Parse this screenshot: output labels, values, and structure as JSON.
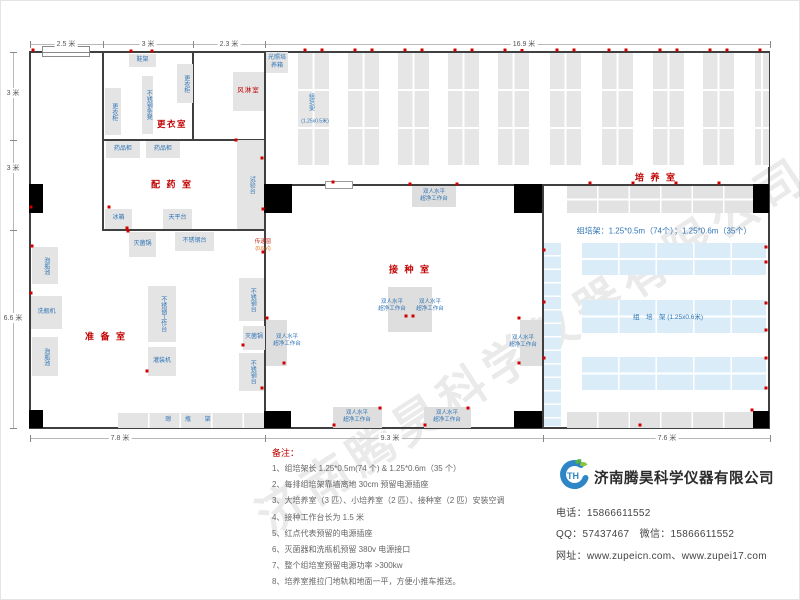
{
  "watermark": "济南腾昊科学仪器有限公司",
  "company": {
    "name": "济南腾昊科学仪器有限公司",
    "logo_text": "TH",
    "logo_colors": {
      "blue": "#2f86c6",
      "green": "#5cb54a"
    },
    "contacts": [
      "电话：15866611552",
      "QQ：57437467　微信：15866611552",
      "网址：www.zupeicn.com、www.zupei17.com"
    ]
  },
  "notes": {
    "title": "备注：",
    "items": [
      "1、组培架长 1.25*0.5m(74 个) & 1.25*0.6m（35 个）",
      "2、每排组培架靠墙离地 30cm 预留电源插座",
      "3、大培养室（3 匹）、小培养室（2 匹）、接种室（2 匹）安装空调",
      "4、接种工作台长为 1.5 米",
      "5、红点代表预留的电源插座",
      "6、灭菌器和洗瓶机预留 380v 电源接口",
      "7、整个组培室预留电源功率 >300kw",
      "8、培养室推拉门地轨和地面一平，方便小推车推送。"
    ]
  },
  "colors": {
    "room_label": "#c00000",
    "equip_label": "#2e74b5",
    "socket_dot": "#d00000",
    "gray_fill": "#e4e4e4",
    "blue_fill": "#d9ecf8",
    "wall": "#3f3f3f"
  },
  "dimensions": {
    "top": {
      "line": {
        "x": 30,
        "y": 44,
        "len": 740
      },
      "ticks": [
        30,
        103,
        193,
        265,
        770
      ],
      "labels": [
        {
          "text": "2.5 米",
          "x": 66
        },
        {
          "text": "3 米",
          "x": 148
        },
        {
          "text": "2.3 米",
          "x": 229
        },
        {
          "text": "16.9 米",
          "x": 524
        }
      ]
    },
    "left": {
      "line": {
        "x": 13,
        "y": 52,
        "len": 376
      },
      "ticks": [
        52,
        140,
        230,
        428
      ],
      "labels": [
        {
          "text": "3 米",
          "y": 93
        },
        {
          "text": "3 米",
          "y": 168
        },
        {
          "text": "6.6 米",
          "y": 318
        }
      ]
    },
    "bottom": {
      "line": {
        "x": 30,
        "y": 438,
        "len": 740
      },
      "ticks": [
        30,
        265,
        543,
        770
      ],
      "labels": [
        {
          "text": "7.8 米",
          "x": 120
        },
        {
          "text": "9.3 米",
          "x": 390
        },
        {
          "text": "7.6 米",
          "x": 667
        }
      ]
    }
  },
  "floorplan": {
    "walls": [
      {
        "id": "top",
        "x": 30,
        "y": 51,
        "w": 740,
        "h": 2
      },
      {
        "id": "bottom",
        "x": 30,
        "y": 427,
        "w": 740,
        "h": 2
      },
      {
        "id": "left",
        "x": 29,
        "y": 51,
        "w": 2,
        "h": 378
      },
      {
        "id": "right",
        "x": 768,
        "y": 51,
        "w": 2,
        "h": 378
      },
      {
        "id": "mid-vertical",
        "x": 264,
        "y": 51,
        "w": 2,
        "h": 377
      },
      {
        "id": "culture-horizontal",
        "x": 264,
        "y": 184,
        "w": 506,
        "h": 2
      },
      {
        "id": "inoculation-right",
        "x": 542,
        "y": 184,
        "w": 2,
        "h": 244
      },
      {
        "id": "dressing-left",
        "x": 102,
        "y": 51,
        "w": 2,
        "h": 180
      },
      {
        "id": "dressing-inner",
        "x": 192,
        "y": 51,
        "w": 2,
        "h": 90
      },
      {
        "id": "dressing-bottom",
        "x": 102,
        "y": 139,
        "w": 164,
        "h": 2
      },
      {
        "id": "dispensing-bottom",
        "x": 102,
        "y": 229,
        "w": 164,
        "h": 2
      }
    ],
    "pillars": [
      {
        "x": 29,
        "y": 184,
        "w": 14,
        "h": 29
      },
      {
        "x": 264,
        "y": 184,
        "w": 28,
        "h": 29
      },
      {
        "x": 514,
        "y": 184,
        "w": 28,
        "h": 29
      },
      {
        "x": 753,
        "y": 184,
        "w": 16,
        "h": 29
      },
      {
        "x": 29,
        "y": 410,
        "w": 14,
        "h": 18
      },
      {
        "x": 264,
        "y": 411,
        "w": 27,
        "h": 17
      },
      {
        "x": 514,
        "y": 411,
        "w": 28,
        "h": 17
      },
      {
        "x": 753,
        "y": 411,
        "w": 16,
        "h": 17
      }
    ],
    "window": {
      "x": 42,
      "y": 46,
      "w": 48,
      "h": 11
    },
    "door": {
      "x": 325,
      "y": 181,
      "w": 28,
      "h": 8
    },
    "equipment": [
      {
        "id": "shoe-rack",
        "label": "鞋架",
        "x": 129,
        "y": 54,
        "w": 27,
        "h": 13,
        "dir": "h"
      },
      {
        "id": "locker-right",
        "label": "更衣柜",
        "x": 177,
        "y": 64,
        "w": 16,
        "h": 39,
        "dir": "v"
      },
      {
        "id": "steel-stool",
        "label": "不锈钢条凳",
        "x": 142,
        "y": 76,
        "w": 11,
        "h": 58,
        "dir": "v"
      },
      {
        "id": "locker-left",
        "label": "更衣柜",
        "x": 105,
        "y": 88,
        "w": 16,
        "h": 47,
        "dir": "v"
      },
      {
        "id": "medicine-cabinet-1",
        "label": "药品柜",
        "x": 106,
        "y": 141,
        "w": 34,
        "h": 17,
        "dir": "h"
      },
      {
        "id": "medicine-cabinet-2",
        "label": "药品柜",
        "x": 146,
        "y": 141,
        "w": 34,
        "h": 17,
        "dir": "h"
      },
      {
        "id": "fridge",
        "label": "冰箱",
        "x": 105,
        "y": 209,
        "w": 27,
        "h": 20,
        "dir": "h"
      },
      {
        "id": "balance-table",
        "label": "天平台",
        "x": 163,
        "y": 209,
        "w": 29,
        "h": 20,
        "dir": "h"
      },
      {
        "id": "test-bench",
        "label": "试验台",
        "x": 237,
        "y": 140,
        "w": 27,
        "h": 89,
        "dir": "v"
      },
      {
        "id": "light-incubator",
        "label": "光照培养箱",
        "x": 266,
        "y": 52,
        "w": 22,
        "h": 21,
        "dir": "h"
      },
      {
        "id": "air-shower",
        "label": "风淋室",
        "x": 233,
        "y": 72,
        "w": 31,
        "h": 39,
        "dir": "h",
        "red": true
      },
      {
        "id": "sterilizer-1",
        "label": "灭菌锅",
        "x": 129,
        "y": 232,
        "w": 27,
        "h": 25,
        "dir": "h"
      },
      {
        "id": "steel-table-1",
        "label": "不锈钢台",
        "x": 175,
        "y": 232,
        "w": 39,
        "h": 19,
        "dir": "h"
      },
      {
        "id": "soak-pool-1",
        "label": "泡瓶池",
        "x": 32,
        "y": 247,
        "w": 26,
        "h": 37,
        "dir": "v"
      },
      {
        "id": "bottle-washer",
        "label": "洗瓶机",
        "x": 31,
        "y": 296,
        "w": 31,
        "h": 33,
        "dir": "h"
      },
      {
        "id": "soak-pool-2",
        "label": "泡瓶池",
        "x": 32,
        "y": 337,
        "w": 26,
        "h": 39,
        "dir": "v"
      },
      {
        "id": "steel-worktable",
        "label": "不锈钢工作台",
        "x": 148,
        "y": 286,
        "w": 28,
        "h": 56,
        "dir": "v"
      },
      {
        "id": "filling-machine",
        "label": "灌装机",
        "x": 148,
        "y": 347,
        "w": 28,
        "h": 29,
        "dir": "h"
      },
      {
        "id": "steel-table-2",
        "label": "不锈钢台",
        "x": 239,
        "y": 278,
        "w": 25,
        "h": 43,
        "dir": "v"
      },
      {
        "id": "sterilizer-2",
        "label": "灭菌锅",
        "x": 243,
        "y": 326,
        "w": 22,
        "h": 24,
        "dir": "h"
      },
      {
        "id": "steel-table-3",
        "label": "不锈钢台",
        "x": 239,
        "y": 353,
        "w": 25,
        "h": 38,
        "dir": "v"
      },
      {
        "id": "drying-rack",
        "label": "晾 瓶 架",
        "x": 118,
        "y": 413,
        "w": 146,
        "h": 15,
        "dir": "h",
        "grid": true
      }
    ],
    "bench_label": [
      "双人水平",
      "超净工作台"
    ],
    "benches": [
      {
        "id": "clean-bench-top",
        "x": 412,
        "y": 186,
        "w": 44,
        "h": 21,
        "lx": 434,
        "ly": 196
      },
      {
        "id": "clean-bench-center-left",
        "x": 388,
        "y": 287,
        "w": 22,
        "h": 45,
        "lx": 392,
        "ly": 306
      },
      {
        "id": "clean-bench-center-right",
        "x": 410,
        "y": 287,
        "w": 22,
        "h": 45,
        "lx": 430,
        "ly": 306
      },
      {
        "id": "clean-bench-right-wall",
        "x": 520,
        "y": 320,
        "w": 22,
        "h": 46,
        "lx": 523,
        "ly": 342
      },
      {
        "id": "clean-bench-left-wall",
        "x": 266,
        "y": 320,
        "w": 21,
        "h": 46,
        "lx": 287,
        "ly": 341
      },
      {
        "id": "clean-bench-bottom-1",
        "x": 333,
        "y": 407,
        "w": 49,
        "h": 21,
        "lx": 357,
        "ly": 417
      },
      {
        "id": "clean-bench-bottom-2",
        "x": 424,
        "y": 407,
        "w": 47,
        "h": 21,
        "lx": 447,
        "ly": 417
      }
    ],
    "racks": {
      "top_columns": {
        "xs": [
          298,
          348,
          398,
          448,
          498,
          550,
          602,
          653,
          703
        ],
        "y": 53,
        "w": 31,
        "h": 114,
        "last": {
          "x": 755,
          "w": 14
        }
      },
      "gray_top": {
        "x": 567,
        "y": 186,
        "w": 186,
        "h": 27
      },
      "gray_bottom": {
        "x": 567,
        "y": 412,
        "w": 186,
        "h": 16
      },
      "blue_strip": {
        "x": 544,
        "y": 243,
        "w": 17,
        "h": 183
      },
      "blue_rows": [
        {
          "x": 582,
          "y": 243,
          "w": 184,
          "h": 32
        },
        {
          "x": 582,
          "y": 300,
          "w": 184,
          "h": 33
        },
        {
          "x": 582,
          "y": 357,
          "w": 184,
          "h": 33
        }
      ]
    },
    "labels": [
      {
        "id": "top-rack-name",
        "text": "组培架",
        "x": 311,
        "y": 102,
        "fs": 6,
        "v": true
      },
      {
        "id": "top-rack-size",
        "text": "(1.25x0.5米)",
        "x": 315,
        "y": 121,
        "fs": 5
      },
      {
        "id": "blue-rack-name",
        "text": "组　培　架 (1.25x0.6米)",
        "x": 668,
        "y": 316,
        "fs": 6.5
      },
      {
        "id": "rack-spec",
        "text": "组培架：1.25*0.5m（74个）；1.25*0.6m（35个）",
        "x": 664,
        "y": 231,
        "fs": 8
      }
    ],
    "rooms": [
      {
        "id": "dressing-room",
        "label": "更衣室",
        "x": 172,
        "y": 124,
        "fs": 8.5,
        "ls": 1.5
      },
      {
        "id": "dispensing-room",
        "label": "配 药 室",
        "x": 172,
        "y": 184,
        "fs": 9,
        "ls": 2
      },
      {
        "id": "prep-room",
        "label": "准 备 室",
        "x": 106,
        "y": 336,
        "fs": 9,
        "ls": 2
      },
      {
        "id": "inoculation-room",
        "label": "接 种 室",
        "x": 410,
        "y": 269,
        "fs": 9,
        "ls": 2
      },
      {
        "id": "culture-room",
        "label": "培 养 室",
        "x": 656,
        "y": 177,
        "fs": 9,
        "ls": 2
      }
    ],
    "pass_window": {
      "lines": [
        "传递窗",
        "(0.6㎡)"
      ],
      "x": 263,
      "y": 246
    },
    "sockets": [
      [
        305,
        50
      ],
      [
        322,
        50
      ],
      [
        355,
        50
      ],
      [
        372,
        50
      ],
      [
        405,
        50
      ],
      [
        422,
        50
      ],
      [
        455,
        50
      ],
      [
        472,
        50
      ],
      [
        505,
        50
      ],
      [
        522,
        50
      ],
      [
        557,
        50
      ],
      [
        574,
        50
      ],
      [
        609,
        50
      ],
      [
        626,
        50
      ],
      [
        660,
        50
      ],
      [
        677,
        50
      ],
      [
        710,
        50
      ],
      [
        727,
        50
      ],
      [
        760,
        50
      ],
      [
        333,
        182
      ],
      [
        410,
        184
      ],
      [
        457,
        184
      ],
      [
        590,
        183
      ],
      [
        633,
        183
      ],
      [
        676,
        183
      ],
      [
        719,
        183
      ],
      [
        766,
        247
      ],
      [
        766,
        262
      ],
      [
        766,
        303
      ],
      [
        766,
        330
      ],
      [
        766,
        358
      ],
      [
        766,
        388
      ],
      [
        544,
        250
      ],
      [
        544,
        302
      ],
      [
        544,
        358
      ],
      [
        640,
        425
      ],
      [
        752,
        410
      ],
      [
        406,
        316
      ],
      [
        413,
        316
      ],
      [
        519,
        318
      ],
      [
        519,
        363
      ],
      [
        334,
        425
      ],
      [
        380,
        408
      ],
      [
        425,
        425
      ],
      [
        468,
        408
      ],
      [
        267,
        318
      ],
      [
        284,
        363
      ],
      [
        128,
        231
      ],
      [
        147,
        371
      ],
      [
        243,
        345
      ],
      [
        262,
        388
      ],
      [
        31,
        293
      ],
      [
        32,
        246
      ],
      [
        109,
        207
      ],
      [
        127,
        228
      ],
      [
        262,
        158
      ],
      [
        263,
        209
      ],
      [
        236,
        140
      ],
      [
        33,
        50
      ],
      [
        131,
        51
      ],
      [
        152,
        51
      ],
      [
        263,
        252
      ],
      [
        31,
        207
      ]
    ]
  }
}
